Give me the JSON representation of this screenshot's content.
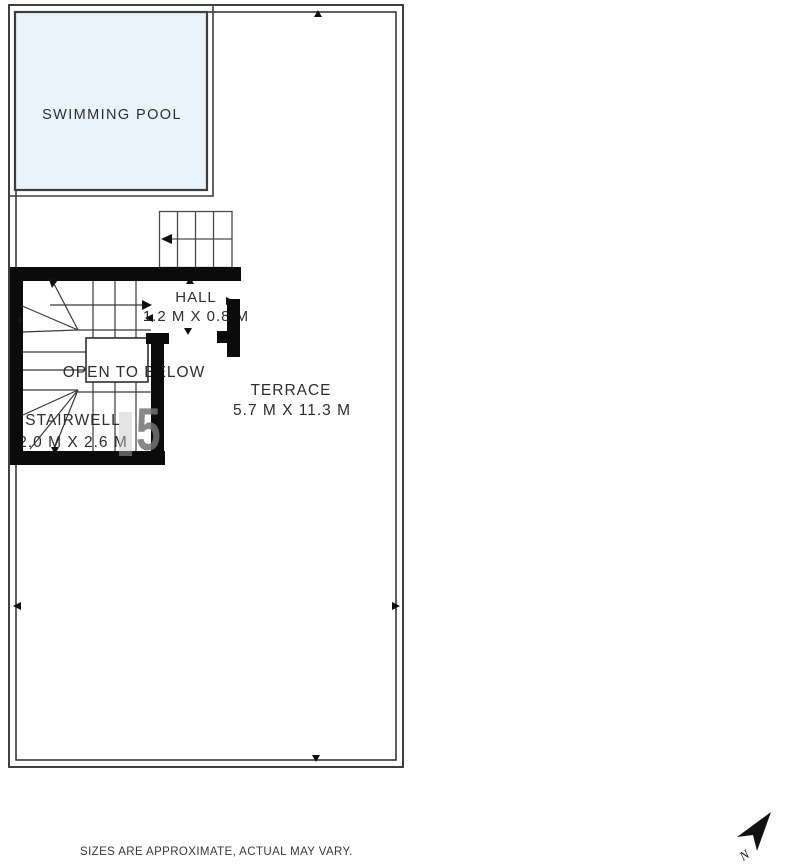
{
  "plan": {
    "pool": {
      "label": "SWIMMING POOL"
    },
    "hall": {
      "label": "HALL",
      "dims": "1.2 M X 0.8 M"
    },
    "open_to_below": {
      "label": "OPEN TO BELOW"
    },
    "stairwell": {
      "label": "STAIRWELL",
      "dims": "2.0 M X 2.6 M"
    },
    "terrace": {
      "label": "TERRACE",
      "dims": "5.7 M X 11.3 M"
    },
    "colors": {
      "pool_fill": "#e8f3fb",
      "wall": "#0b0b0b",
      "linework": "#3a3a3a",
      "label_text": "#2e2e2e",
      "watermark_gray": "#737373"
    }
  },
  "watermark": {
    "text": "5"
  },
  "compass": {
    "label": "N"
  },
  "footer": {
    "disclaimer": "SIZES ARE APPROXIMATE, ACTUAL MAY VARY."
  }
}
